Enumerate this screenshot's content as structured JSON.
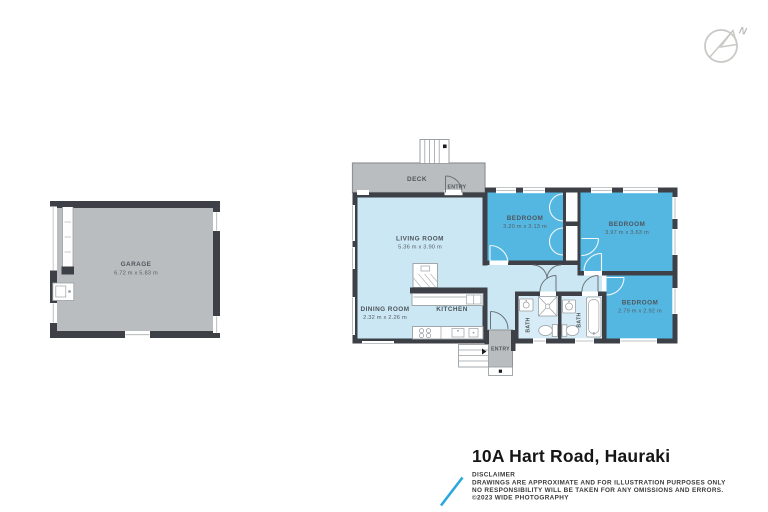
{
  "compass": {
    "north_label": "N"
  },
  "floorplan": {
    "rooms": {
      "garage": {
        "name": "GARAGE",
        "dimensions": "6.72 m x 5.83 m"
      },
      "deck": {
        "name": "DECK"
      },
      "entry_top": {
        "name": "ENTRY"
      },
      "entry_bottom": {
        "name": "ENTRY"
      },
      "living_room": {
        "name": "LIVING ROOM",
        "dimensions": "5.36 m x 3.90 m"
      },
      "dining_room": {
        "name": "DINING ROOM",
        "dimensions": "2.32 m x 2.26 m"
      },
      "kitchen": {
        "name": "KITCHEN"
      },
      "bedroom_1": {
        "name": "BEDROOM",
        "dimensions": "3.20 m x 3.13 m"
      },
      "bedroom_2": {
        "name": "BEDROOM",
        "dimensions": "3.97 m x 3.63 m"
      },
      "bedroom_3": {
        "name": "BEDROOM",
        "dimensions": "2.79 m x 2.92 m"
      },
      "bath_1": {
        "name": "BATH"
      },
      "bath_2": {
        "name": "BATH"
      }
    },
    "colors": {
      "wall": "#3d4147",
      "living_area_fill": "#cbe7f3",
      "bedroom_fill": "#54b7e2",
      "outdoor_fill": "#b9bdc0",
      "fixture_outline": "#9aa0a4",
      "label_text": "#4e565c",
      "logo_accent": "#29a8e0"
    }
  },
  "footer": {
    "title": "10A Hart Road, Hauraki",
    "disclaimer_heading": "DISCLAIMER",
    "disclaimer_line1": "DRAWINGS ARE APPROXIMATE AND FOR ILLUSTRATION PURPOSES ONLY",
    "disclaimer_line2": "NO RESPONSIBILITY WILL BE TAKEN FOR ANY OMISSIONS AND ERRORS.",
    "copyright": "©2023 WIDE PHOTOGRAPHY"
  }
}
